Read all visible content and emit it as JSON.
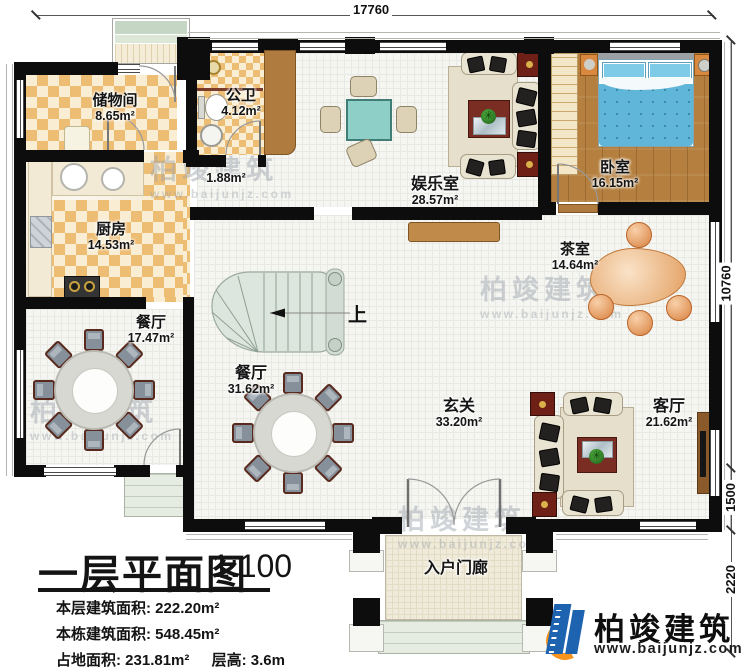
{
  "dimensions": {
    "top": "17760",
    "right": [
      "10760",
      "1500",
      "2220"
    ]
  },
  "rooms": {
    "storage": {
      "name": "储物间",
      "area": "8.65m²"
    },
    "bathroom": {
      "name": "公卫",
      "area": "4.12m²"
    },
    "lobby": {
      "area": "1.88m²"
    },
    "entertainment": {
      "name": "娱乐室",
      "area": "28.57m²"
    },
    "bedroom": {
      "name": "卧室",
      "area": "16.15m²"
    },
    "kitchen": {
      "name": "厨房",
      "area": "14.53m²"
    },
    "tearoom": {
      "name": "茶室",
      "area": "14.64m²"
    },
    "dining_small": {
      "name": "餐厅",
      "area": "17.47m²"
    },
    "dining_large": {
      "name": "餐厅",
      "area": "31.62m²"
    },
    "foyer": {
      "name": "玄关",
      "area": "33.20m²"
    },
    "living": {
      "name": "客厅",
      "area": "21.62m²"
    },
    "porch": {
      "name": "入户门廊"
    }
  },
  "stairs": {
    "up_label": "上"
  },
  "title_block": {
    "title": "一层平面图",
    "scale": "1:100",
    "row1_label": "本层建筑面积:",
    "row1_value": "222.20m²",
    "row2_label": "本栋建筑面积:",
    "row2_value": "548.45m²",
    "row3_label": "占地面积:",
    "row3_value": "231.81m²",
    "row3b_label": "层高:",
    "row3b_value": "3.6m"
  },
  "branding": {
    "company": "柏竣建筑",
    "website": "www.baijunjz.com"
  },
  "watermark": {
    "text": "柏竣建筑",
    "url": "www.baijunjz.com"
  },
  "colors": {
    "wall": "#0d0d0d",
    "checker": "#eebd74",
    "wood": "#b5803f",
    "accent_blue": "#1e63b0",
    "accent_orange": "#f7941d"
  }
}
